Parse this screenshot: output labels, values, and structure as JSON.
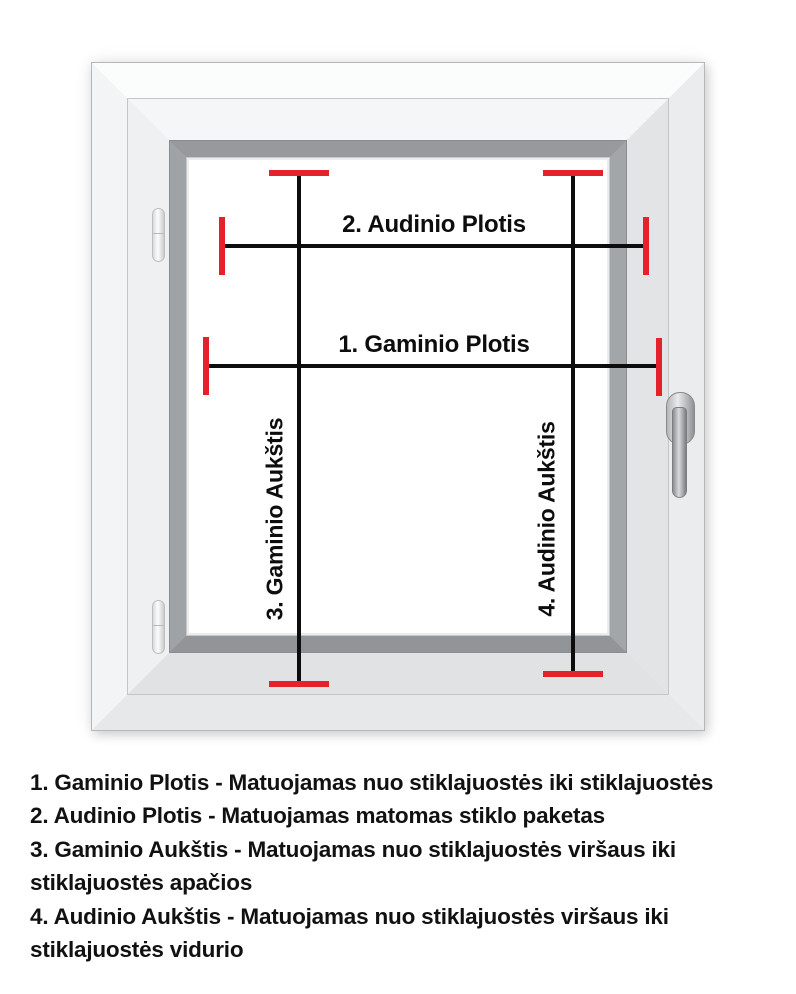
{
  "diagram": {
    "measurements": {
      "gaminio_plotis": {
        "label": "1. Gaminio Plotis"
      },
      "audinio_plotis": {
        "label": "2. Audinio Plotis"
      },
      "gaminio_aukstis": {
        "label": "3. Gaminio Aukštis"
      },
      "audinio_aukstis": {
        "label": "4. Audinio Aukštis"
      }
    },
    "colors": {
      "marker_red": "#e5212b",
      "line_black": "#0d0d0d",
      "bead_gray": "#9a9da0"
    }
  },
  "legend": {
    "lines": [
      "1. Gaminio Plotis - Matuojamas nuo stiklajuostės iki stiklajuostės",
      "2. Audinio Plotis - Matuojamas matomas stiklo paketas",
      "3. Gaminio Aukštis - Matuojamas nuo stiklajuostės viršaus iki",
      "stiklajuostės apačios",
      "4. Audinio Aukštis - Matuojamas nuo stiklajuostės viršaus iki",
      "stiklajuostės vidurio"
    ]
  }
}
